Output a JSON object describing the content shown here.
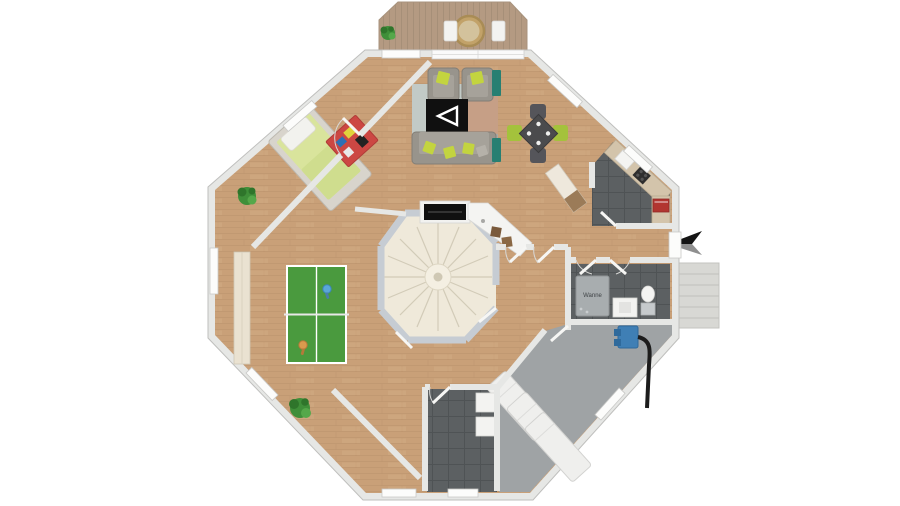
{
  "plan": {
    "type": "floor-plan",
    "labels": {
      "bathtub": "Wanne"
    },
    "colors": {
      "background": "#ffffff",
      "wood_floor": "#c9a078",
      "wood_plank_line": "#b68e66",
      "deck_wood": "#b49a82",
      "deck_plank_line": "#a28c76",
      "tile_dark": "#5c6062",
      "tile_grid": "#4f5355",
      "utility_floor": "#9fa3a5",
      "wall": "#e6e7e5",
      "wall_edge": "#bfbfbd",
      "stair_wall": "#c6ccd3",
      "stair_step": "#efe9da",
      "pingpong_green": "#4a9a3e",
      "lime_accent": "#c3d43f",
      "sofa_gray": "#98948c",
      "rug_red": "#cc4743",
      "bed_green": "#d9e49c",
      "teal_cabinet": "#277f72",
      "north_arrow_dark": "#141414",
      "north_arrow_light": "#8f8f8f",
      "heater_blue": "#3f7fb5",
      "oven_red": "#b23530",
      "fireplace_black": "#101010"
    },
    "icons": {
      "north_arrow": "compass-arrow-west-icon",
      "plant": "potted-plant-icon",
      "staircase": "spiral-staircase-icon",
      "tv": "tv-play-triangle-icon"
    }
  }
}
